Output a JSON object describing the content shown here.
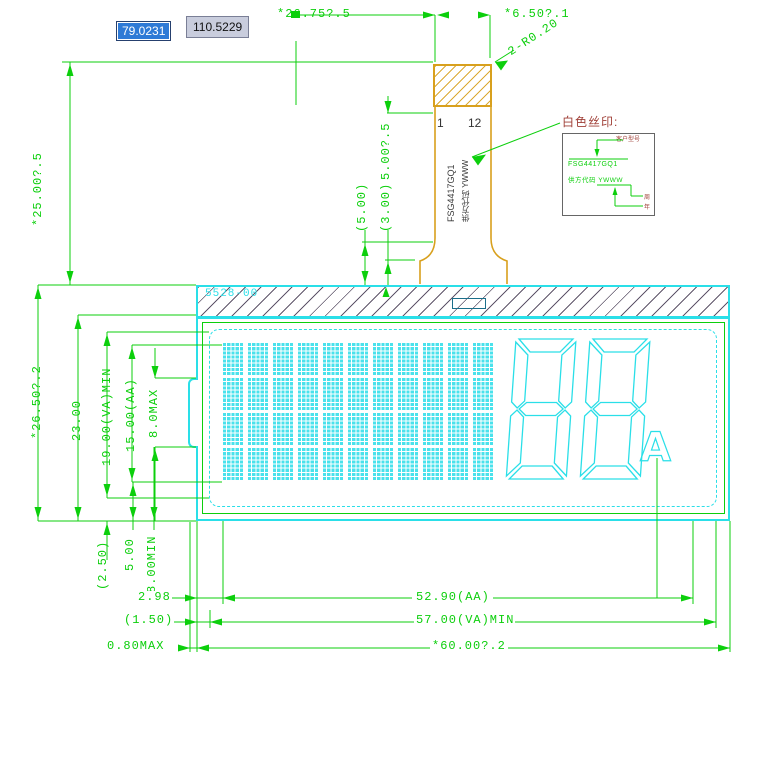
{
  "app": {
    "coord_input_x": "79.0231",
    "coord_input_y": "110.5229"
  },
  "dims": {
    "top_width": "*26.75?.5",
    "tail_width": "*6.50?.1",
    "radius_callout": "2-R0.20",
    "tail_length": "*25.00?.5",
    "module_height": "*26.50?.2",
    "glass_height": "23.00",
    "va_height": "19.00(VA)MIN",
    "aa_height": "15.00(AA)",
    "tab_height": "8.0MAX",
    "stiffener_len": "5.00?.5",
    "flare_len": "(5.00)",
    "neck_len": "(3.00)",
    "bottom_step": "(2.50)",
    "bottom_gap": "5.00",
    "bottom_min": "8.00MIN",
    "edge_to_aa": "2.98",
    "edge_to_va": "(1.50)",
    "edge_max": "0.80MAX",
    "aa_width": "52.90(AA)",
    "va_width": "57.00(VA)MIN",
    "module_width": "*60.00?.2"
  },
  "fpc": {
    "pin_first": "1",
    "pin_last": "12",
    "silk_line1": "FSG4417GQ1",
    "silk_line2": "供方代码 YWWW"
  },
  "module": {
    "glass_label": "5528-00"
  },
  "display": {
    "matrix": {
      "cols": 11,
      "rows": 4
    },
    "digit_count": 2,
    "annunciator": "A"
  },
  "callout": {
    "title": "白色丝印:",
    "box_line1": "FSG4417GQ1",
    "box_line2": "供方代码 YWWW",
    "label_top": "客户型号",
    "label_week": "周",
    "label_year": "年"
  },
  "colors": {
    "dimension_green": "#0ccf0c",
    "lcd_cyan": "#2adfe8",
    "fpc_orange": "#d8a01d",
    "callout_maroon": "#a04038",
    "input_highlight_blue": "#2e7ad6"
  }
}
